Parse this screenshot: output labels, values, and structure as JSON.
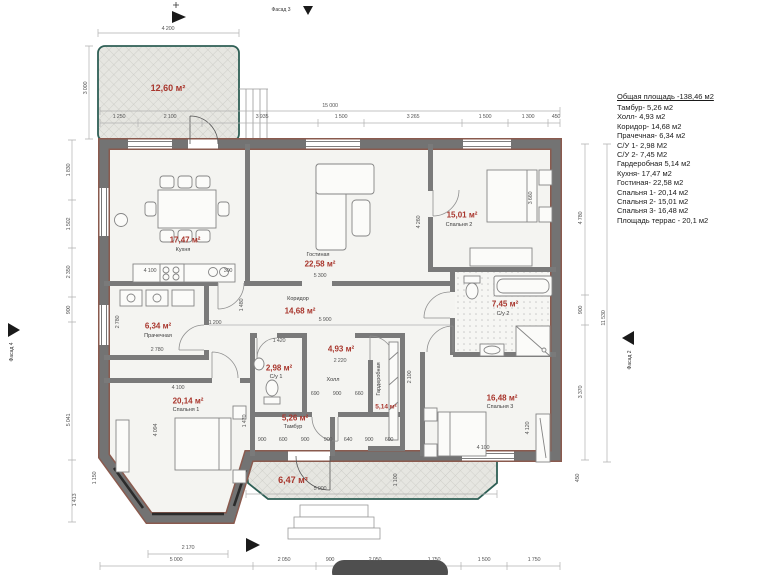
{
  "legend": {
    "title": "Общая площадь -138,46 м2",
    "items": [
      "Тамбур- 5,26 м2",
      "Холл- 4,93 м2",
      "Коридор- 14,68 м2",
      "Прачечная- 6,34 м2",
      "С/У 1- 2,98 М2",
      "С/У 2- 7,45 М2",
      "Гардеробная 5,14 м2",
      "Кухня- 17,47 м2",
      "Гостиная- 22,58 м2",
      "Спальня 1- 20,14 м2",
      "Спальня 2- 15,01 м2",
      "Спальня 3- 16,48 м2",
      "Площадь террас - 20,1 м2"
    ]
  },
  "rooms": {
    "kitchen": {
      "name": "Кухня",
      "area": "17,47 м²"
    },
    "living": {
      "name": "Гостиная",
      "area": "22,58 м²"
    },
    "bedroom2": {
      "name": "Спальня 2",
      "area": "15,01 м²"
    },
    "corridor": {
      "name": "Коридор",
      "area": "14,68 м²"
    },
    "laundry": {
      "name": "Прачечная",
      "area": "6,34 м²"
    },
    "wc1": {
      "name": "С/у 1",
      "area": "2,98 м²"
    },
    "hall": {
      "name": "Холл",
      "area": "4,93 м²"
    },
    "wardrobe": {
      "name": "Гардеробная",
      "area": "5,14 м²"
    },
    "wc2": {
      "name": "С/у 2",
      "area": "7,45 м²"
    },
    "bedroom1": {
      "name": "Спальня 1",
      "area": "20,14 м²"
    },
    "bedroom3": {
      "name": "Спальня 3",
      "area": "16,48 м²"
    },
    "tambour": {
      "name": "Тамбур",
      "area": "5,26 м²"
    },
    "terrace_top": {
      "area": "12,60 м²"
    },
    "terrace_bottom": {
      "area": "6,47 м²"
    }
  },
  "facades": {
    "f2": "Фасад 2",
    "f3": "Фасад 3",
    "f4": "Фасад 4"
  },
  "dims": {
    "terrace_top_w": "4 200",
    "terrace_top_h": "3 000",
    "top_total": "15 000",
    "top_segs": [
      "1 250",
      "2 100",
      "3 935",
      "1 500",
      "3 265",
      "1 500",
      "1 300",
      "450"
    ],
    "left_segs": [
      "1 830",
      "1 502",
      "2 350",
      "900",
      "5 041",
      "1 413",
      "1 150"
    ],
    "right_segs": [
      "4 780",
      "900",
      "3 370"
    ],
    "right_total": "11 530",
    "right_450": "450",
    "bottom_segs": [
      "5 000",
      "2 050",
      "900",
      "2 050",
      "1 750",
      "1 500",
      "1 750"
    ],
    "bay_w": "2 170",
    "kitchen_w": "4 100",
    "kitchen_300": "300",
    "living_w": "5 300",
    "living_h": "4 260",
    "bed2_h": "3 660",
    "corridor_w": "5 900",
    "corridor_1480": "1 480",
    "corridor_1200": "1 200",
    "laundry_w": "2 780",
    "laundry_h": "2 780",
    "wc1_w": "1 420",
    "hall_w": "2 220",
    "hall_row": [
      "690",
      "900",
      "660"
    ],
    "wardrobe_h": "2 100",
    "bed1_w": "4 100",
    "bed1_h": "4 094",
    "bed3_w": "4 100",
    "bed3_h": "4 120",
    "tambour_h": "1 470",
    "terrace2_w": "5 000",
    "terrace2_h": "1 100",
    "bottom_row": [
      "900",
      "600",
      "900",
      "900",
      "640",
      "900",
      "600"
    ]
  },
  "colors": {
    "area_text": "#a8352c",
    "wall": "#737373",
    "wall_edge": "#8a5a4e",
    "terrace_border": "#2e5f55",
    "dim_text": "#5a5a5a"
  }
}
